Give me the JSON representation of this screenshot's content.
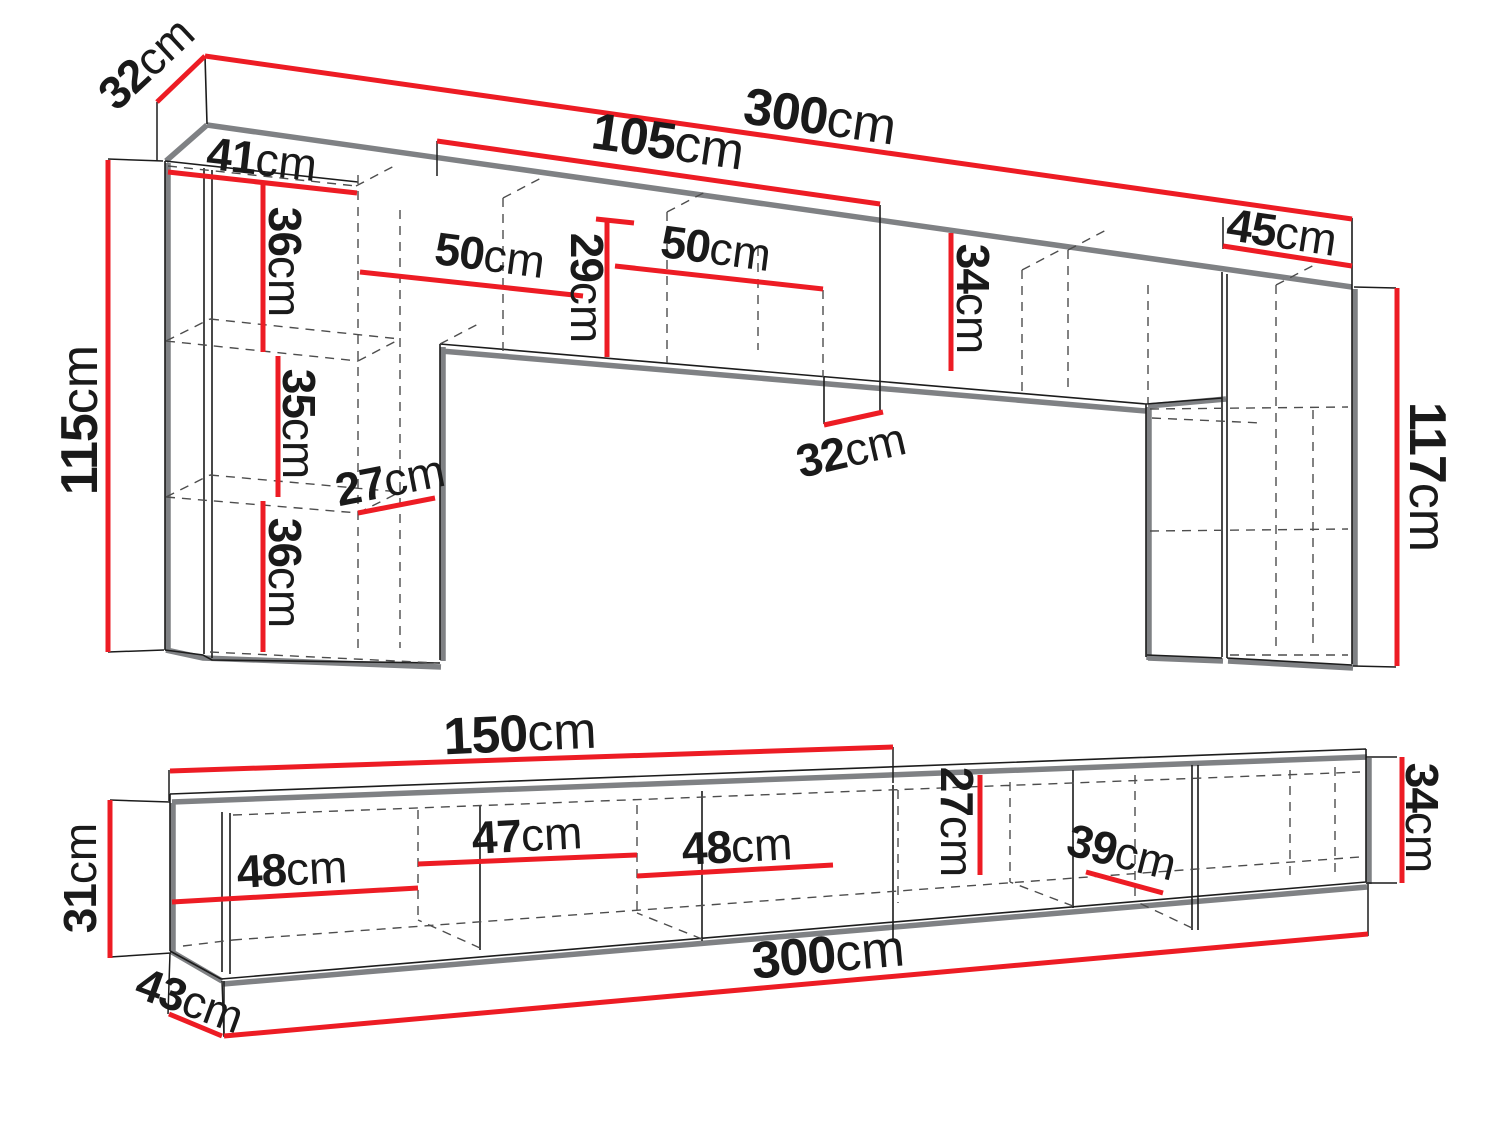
{
  "diagram_type": "furniture-dimension-drawing",
  "unit_suffix": "cm",
  "colors": {
    "dimension_red": "#ed1c24",
    "outline_black": "#1c1c1c",
    "shadow_gray": "#7f8184",
    "hidden_gray": "#4d4d4d",
    "background": "#ffffff"
  },
  "views": {
    "wall_unit": {
      "name": "wall-unit-front-view",
      "dimensions": [
        {
          "value": "32",
          "unit": "cm",
          "line": [
            157,
            102,
            205,
            56
          ],
          "label": [
            146,
            63
          ],
          "rotate": -43,
          "size": 46,
          "ticks": [
            [
              157,
              102,
              157,
              161
            ]
          ]
        },
        {
          "value": "300",
          "unit": "cm",
          "line": [
            205,
            56,
            1352,
            219
          ],
          "label": [
            820,
            117
          ],
          "rotate": 8.2,
          "size": 52,
          "ticks": []
        },
        {
          "value": "105",
          "unit": "cm",
          "line": [
            437,
            141,
            880,
            204
          ],
          "label": [
            668,
            142
          ],
          "rotate": 8.2,
          "size": 52,
          "ticks": [
            [
              437,
              141,
              437,
              176
            ]
          ]
        },
        {
          "value": "41",
          "unit": "cm",
          "line": [
            168,
            172,
            357,
            193
          ],
          "label": [
            262,
            159
          ],
          "rotate": 6.5,
          "size": 46,
          "ticks": []
        },
        {
          "value": "36",
          "unit": "cm",
          "line": [
            263,
            181,
            263,
            352
          ],
          "label": [
            285,
            262
          ],
          "rotate": 90,
          "size": 46,
          "ticks": []
        },
        {
          "value": "50",
          "unit": "cm",
          "line": [
            360,
            272,
            583,
            296
          ],
          "label": [
            490,
            255
          ],
          "rotate": 7.5,
          "size": 46,
          "ticks": []
        },
        {
          "value": "29",
          "unit": "cm",
          "line": [
            607,
            221,
            607,
            357
          ],
          "line2": [
            596,
            219,
            634,
            223
          ],
          "label": [
            587,
            288
          ],
          "rotate": 90,
          "size": 46,
          "ticks": []
        },
        {
          "value": "50",
          "unit": "cm",
          "line": [
            615,
            266,
            823,
            289
          ],
          "label": [
            716,
            248
          ],
          "rotate": 7.5,
          "size": 46,
          "ticks": []
        },
        {
          "value": "34",
          "unit": "cm",
          "line": [
            951,
            233,
            951,
            371
          ],
          "label": [
            973,
            299
          ],
          "rotate": 90,
          "size": 46,
          "ticks": []
        },
        {
          "value": "32",
          "unit": "cm",
          "line": [
            824,
            425,
            883,
            412
          ],
          "label": [
            851,
            450
          ],
          "rotate": -13,
          "size": 46,
          "ticks": []
        },
        {
          "value": "45",
          "unit": "cm",
          "line": [
            1223,
            246,
            1352,
            266
          ],
          "label": [
            1282,
            232
          ],
          "rotate": 8.5,
          "size": 46,
          "ticks": [
            [
              1223,
              217,
              1223,
              249
            ]
          ]
        },
        {
          "value": "115",
          "unit": "cm",
          "line": [
            108,
            160,
            108,
            652
          ],
          "label": [
            80,
            420
          ],
          "rotate": -90,
          "size": 52,
          "ticks": [
            [
              108,
              159,
              163,
              161
            ],
            [
              108,
              652,
              164,
              650
            ]
          ]
        },
        {
          "value": "35",
          "unit": "cm",
          "line": [
            278,
            356,
            278,
            497
          ],
          "label": [
            299,
            424
          ],
          "rotate": 90,
          "size": 46,
          "ticks": []
        },
        {
          "value": "27",
          "unit": "cm",
          "line": [
            358,
            513,
            435,
            498
          ],
          "label": [
            390,
            480
          ],
          "rotate": -11,
          "size": 46,
          "ticks": []
        },
        {
          "value": "36",
          "unit": "cm",
          "line": [
            263,
            501,
            263,
            652
          ],
          "label": [
            285,
            573
          ],
          "rotate": 90,
          "size": 46,
          "ticks": []
        },
        {
          "value": "117",
          "unit": "cm",
          "line": [
            1397,
            288,
            1397,
            666
          ],
          "label": [
            1427,
            477
          ],
          "rotate": 90,
          "size": 52,
          "ticks": [
            [
              1354,
              287,
              1396,
              288
            ],
            [
              1353,
              666,
              1396,
              667
            ]
          ]
        }
      ]
    },
    "tv_stand": {
      "name": "tv-stand-front-view",
      "dimensions": [
        {
          "value": "150",
          "unit": "cm",
          "line": [
            170,
            771,
            893,
            747
          ],
          "label": [
            520,
            734
          ],
          "rotate": -2.5,
          "size": 52,
          "ticks": [
            [
              169,
              770,
              169,
              801
            ],
            [
              893,
              747,
              893,
              783
            ]
          ]
        },
        {
          "value": "31",
          "unit": "cm",
          "line": [
            110,
            800,
            110,
            958
          ],
          "label": [
            80,
            878
          ],
          "rotate": -90,
          "size": 46,
          "ticks": [
            [
              110,
              800,
              170,
              802
            ],
            [
              110,
              957,
              171,
              953
            ]
          ]
        },
        {
          "value": "48",
          "unit": "cm",
          "line": [
            172,
            902,
            418,
            888
          ],
          "label": [
            292,
            869
          ],
          "rotate": -3,
          "size": 46,
          "ticks": []
        },
        {
          "value": "47",
          "unit": "cm",
          "line": [
            418,
            864,
            637,
            855
          ],
          "label": [
            527,
            835
          ],
          "rotate": -3,
          "size": 46,
          "ticks": []
        },
        {
          "value": "48",
          "unit": "cm",
          "line": [
            637,
            876,
            833,
            865
          ],
          "label": [
            737,
            846
          ],
          "rotate": -3,
          "size": 46,
          "ticks": []
        },
        {
          "value": "27",
          "unit": "cm",
          "line": [
            980,
            775,
            980,
            875
          ],
          "label": [
            957,
            822
          ],
          "rotate": 90,
          "size": 46,
          "ticks": []
        },
        {
          "value": "39",
          "unit": "cm",
          "line": [
            1086,
            872,
            1163,
            893
          ],
          "label": [
            1122,
            852
          ],
          "rotate": 14,
          "size": 46,
          "ticks": []
        },
        {
          "value": "34",
          "unit": "cm",
          "line": [
            1402,
            757,
            1402,
            883
          ],
          "label": [
            1422,
            818
          ],
          "rotate": 90,
          "size": 46,
          "ticks": [
            [
              1366,
              757,
              1397,
              757
            ],
            [
              1366,
              883,
              1397,
              883
            ]
          ]
        },
        {
          "value": "43",
          "unit": "cm",
          "line": [
            169,
            1014,
            222,
            1036
          ],
          "label": [
            190,
            1000
          ],
          "rotate": 20,
          "size": 46,
          "ticks": [
            [
              170,
              953,
              168,
              1014
            ],
            [
              222,
              981,
              224,
              1036
            ]
          ]
        },
        {
          "value": "300",
          "unit": "cm",
          "line": [
            224,
            1036,
            1368,
            934
          ],
          "label": [
            828,
            955
          ],
          "rotate": -5,
          "size": 52,
          "ticks": [
            [
              224,
              981,
              224,
              1037
            ],
            [
              1368,
              884,
              1368,
              936
            ]
          ]
        }
      ]
    }
  }
}
